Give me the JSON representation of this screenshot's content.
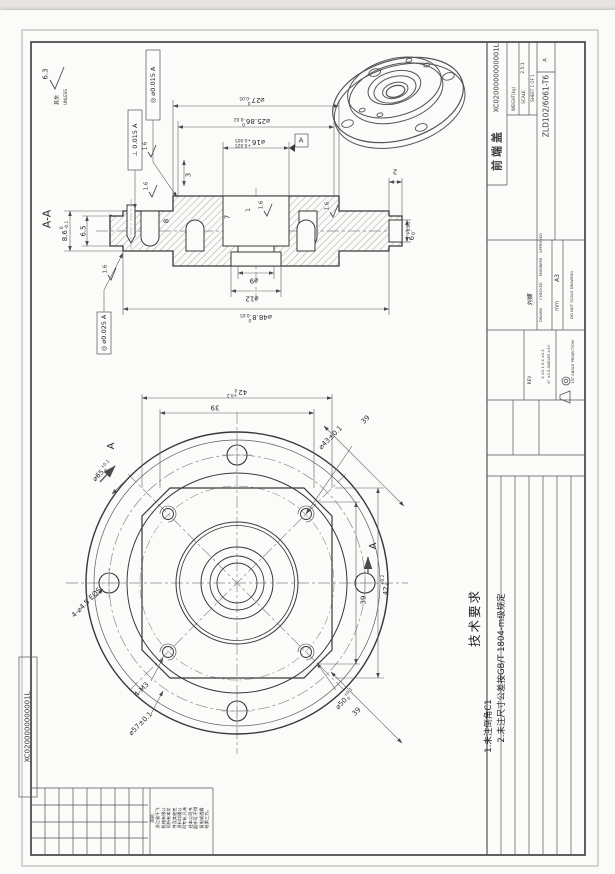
{
  "page": {
    "sheet_code_left": "XC0200000000001L"
  },
  "titleblock": {
    "drawing_no": "XC0200000000001L",
    "part_name": "前端盖",
    "material": "ZLD102/6061-T6",
    "weight_label": "WEIGHT(kg)",
    "scale_label": "SCALE",
    "scale_value": "2.5:1",
    "sheet_label": "SHEET 1 OF 1",
    "rev_value": "A",
    "size_value": "A3",
    "units_value": "mm",
    "no_scale": "DO NOT SCALE DRAWING",
    "projection": "1ST ANGLE PROJECTION",
    "drawn_label": "DRAWN",
    "checked_label": "CHECKED",
    "engineer_label": "ENGINEER",
    "approved_label": "APPROVED",
    "signature": "刘横",
    "rev_label": "REV",
    "tol_line1": "X ±0.1  X.X ±0.2",
    "tol_line2": "X° ±0.5  ANGLES ±30'"
  },
  "notes": {
    "heading": "技术要求",
    "items": [
      "1.未注倒角C1",
      "2.未注尺寸公差按GB/T 1804-m级规定"
    ]
  },
  "notice": {
    "lines": [
      "声明:",
      "浙江省千飞",
      "机械有限公",
      "司所有本文",
      "件及其他性",
      "资料均属公",
      "司专有,凡未",
      "经本公司书",
      "面许可,不得",
      "复制或透露",
      "给第三方。"
    ]
  },
  "colors": {
    "line": "#3a3a3a",
    "dim": "#5f5f5f",
    "center": "#8a8a8a",
    "paper": "#fbfbf9"
  },
  "labels": [
    {
      "t": "A-A",
      "x": 47,
      "y": 219,
      "r": -90,
      "s": 11,
      "n": "section-title"
    },
    {
      "t": "⌀27",
      "sup": "0",
      "sub": "-0.05",
      "x": 252,
      "y": 99,
      "r": 180,
      "s": 7,
      "n": "dim-d27"
    },
    {
      "t": "⌀25.86",
      "sup": "0",
      "sub": "-0.02",
      "x": 252,
      "y": 120,
      "r": 180,
      "s": 7,
      "n": "dim-d25-86"
    },
    {
      "t": "⌀16",
      "sup": "+0.025",
      "sub": "+0.005",
      "x": 250,
      "y": 141,
      "r": 180,
      "s": 7,
      "n": "dim-d16"
    },
    {
      "t": "3",
      "x": 189,
      "y": 175,
      "r": -90,
      "s": 7,
      "n": "dim-3"
    },
    {
      "t": "2",
      "x": 395,
      "y": 171,
      "r": 180,
      "s": 7,
      "n": "dim-2"
    },
    {
      "t": "6",
      "sup": "+0.05",
      "sub": "0",
      "x": 413,
      "y": 231,
      "r": -90,
      "s": 7,
      "n": "dim-6"
    },
    {
      "t": "7",
      "x": 113,
      "y": 216,
      "r": -90,
      "s": 7,
      "n": "dim-7-rim"
    },
    {
      "t": "6.5",
      "x": 84,
      "y": 231,
      "r": -90,
      "s": 7,
      "n": "dim-6-5"
    },
    {
      "t": "8.6",
      "sup": "0",
      "sub": "-0.1",
      "x": 66,
      "y": 231,
      "r": -90,
      "s": 7,
      "n": "dim-8-6"
    },
    {
      "t": "8",
      "x": 167,
      "y": 221,
      "r": -90,
      "s": 7,
      "n": "dim-8"
    },
    {
      "t": "7",
      "x": 228,
      "y": 217,
      "r": -90,
      "s": 7,
      "n": "dim-7-bore"
    },
    {
      "t": "1",
      "x": 249,
      "y": 210,
      "r": -90,
      "s": 6,
      "n": "dim-1"
    },
    {
      "t": "⌀9",
      "x": 254,
      "y": 280,
      "r": 180,
      "s": 7,
      "n": "dim-d9"
    },
    {
      "t": "⌀12",
      "x": 252,
      "y": 298,
      "r": 180,
      "s": 7,
      "n": "dim-d12"
    },
    {
      "t": "⌀48.8",
      "sup": "0",
      "sub": "-0.05",
      "x": 256,
      "y": 316,
      "r": 180,
      "s": 7,
      "n": "dim-d48-8"
    },
    {
      "t": "⊥ 0.015 A",
      "x": 135,
      "y": 140,
      "r": -90,
      "s": 6.5,
      "n": "fcf-perpendicularity"
    },
    {
      "t": "◎ ⌀0.015 A",
      "x": 153,
      "y": 85,
      "r": -90,
      "s": 6.5,
      "n": "fcf-concentricity-1"
    },
    {
      "t": "◎ ⌀0.025 A",
      "x": 104,
      "y": 333,
      "r": -90,
      "s": 6.5,
      "n": "fcf-concentricity-2"
    },
    {
      "t": "A",
      "x": 301,
      "y": 141,
      "r": 0,
      "s": 7,
      "n": "datum-a-label"
    },
    {
      "t": "6.3",
      "x": 46,
      "y": 74,
      "r": -90,
      "s": 7,
      "n": "surface-roughness-value"
    },
    {
      "t": "其余",
      "x": 58,
      "y": 100,
      "r": -90,
      "s": 5,
      "n": "surface-note-cn"
    },
    {
      "t": "UNLESS",
      "x": 66,
      "y": 97,
      "r": -90,
      "s": 4,
      "n": "surface-note-en"
    },
    {
      "t": "1.6",
      "x": 146,
      "y": 146,
      "r": -90,
      "s": 5.5,
      "n": "roughness-1-6"
    },
    {
      "t": "1.6",
      "x": 147,
      "y": 186,
      "r": -90,
      "s": 5.5,
      "n": "roughness-1-6"
    },
    {
      "t": "1.6",
      "x": 106,
      "y": 269,
      "r": -90,
      "s": 5.5,
      "n": "roughness-1-6"
    },
    {
      "t": "1.6",
      "x": 262,
      "y": 205,
      "r": -90,
      "s": 5.5,
      "n": "roughness-1-6"
    },
    {
      "t": "1.6",
      "x": 328,
      "y": 206,
      "r": -90,
      "s": 5.5,
      "n": "roughness-1-6"
    },
    {
      "t": "42",
      "sup": "+0.2",
      "sub": "0",
      "x": 237,
      "y": 391,
      "r": 180,
      "s": 7,
      "n": "dim-42-top"
    },
    {
      "t": "39",
      "x": 215,
      "y": 407,
      "r": 180,
      "s": 7,
      "n": "dim-39-top"
    },
    {
      "t": "39",
      "x": 366,
      "y": 420,
      "r": -45,
      "s": 7,
      "n": "dim-39-diag-tr"
    },
    {
      "t": "⌀43±0.1",
      "x": 331,
      "y": 438,
      "r": -45,
      "s": 7,
      "n": "dim-d43"
    },
    {
      "t": "⌀65",
      "sup": "+0.1",
      "sub": "0",
      "x": 103,
      "y": 472,
      "r": -45,
      "s": 7,
      "n": "dim-d65"
    },
    {
      "t": "A",
      "x": 112,
      "y": 446,
      "r": -90,
      "s": 10,
      "n": "section-arrow-label"
    },
    {
      "t": "A",
      "x": 374,
      "y": 546,
      "r": -90,
      "s": 10,
      "n": "section-arrow-label"
    },
    {
      "t": "42",
      "sup": "+0.2",
      "sub": "0",
      "x": 387,
      "y": 585,
      "r": -90,
      "s": 7,
      "n": "dim-42-right"
    },
    {
      "t": "39",
      "x": 364,
      "y": 600,
      "r": -90,
      "s": 7,
      "n": "dim-39-right"
    },
    {
      "t": "4-⌀4.5 EQS",
      "x": 87,
      "y": 603,
      "r": -45,
      "s": 7,
      "n": "hole-callout"
    },
    {
      "t": "4-M3",
      "x": 142,
      "y": 690,
      "r": -45,
      "s": 7,
      "n": "thread-callout"
    },
    {
      "t": "⌀57±0.1",
      "x": 141,
      "y": 724,
      "r": -45,
      "s": 7,
      "n": "dim-d57"
    },
    {
      "t": "⌀50",
      "sup": "+0.1",
      "sub": "0",
      "x": 346,
      "y": 700,
      "r": -45,
      "s": 7,
      "n": "dim-d50"
    },
    {
      "t": "39",
      "x": 357,
      "y": 712,
      "r": -45,
      "s": 7,
      "n": "dim-39-diag-br"
    }
  ]
}
